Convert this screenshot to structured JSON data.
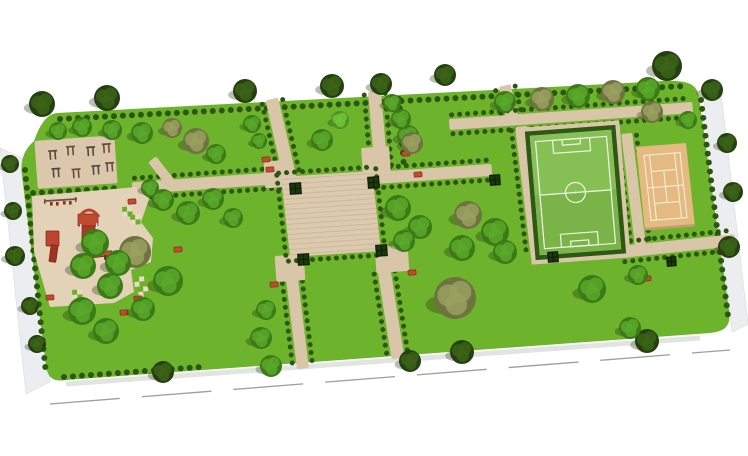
{
  "canvas": {
    "width": 748,
    "height": 456,
    "background": "#ffffff"
  },
  "palette": {
    "lawn": "#6db32c",
    "path": "#d9c6a8",
    "plaza": "#dccaae",
    "plaza_stripe": "#c9b493",
    "playground": "#e3d2b8",
    "fitness": "#dbc8ac",
    "pitch": "#86c055",
    "pitch_shade": "#7ab449",
    "pitch_line": "#eef7e6",
    "court": "#e4ba80",
    "court_edge": "#bf9e6b",
    "court_line": "#f7f2e8",
    "hedge": "#2c5512",
    "field_hedge": "#2d5a13",
    "planter_fill": "#1b370c",
    "planter_stroke": "#0a1804",
    "red": "#c14a2f",
    "red_dark": "#7c2517",
    "equipment": "#54483a",
    "equipment_alt": "#6b4a3a",
    "sidewalk": "#ecedf0",
    "sidewalk_edge": "#d9dbe0",
    "road_line": "#9c9ea0",
    "tree_shadow": "rgba(30,40,15,0.30)",
    "edge_shadow": "rgba(110,120,110,0.20)",
    "checker_green": "#6fae2c",
    "checker_cream": "#e8dcc4",
    "swing_frame": "#6a543e",
    "swing_seat": "#8a3020"
  },
  "tree_variants": {
    "dark": [
      "#234010",
      "#3c6318"
    ],
    "green": [
      "#3a7a17",
      "#5aa82c"
    ],
    "light": [
      "#4d9322",
      "#72c337"
    ],
    "olive": [
      "#6e7340",
      "#99a060"
    ]
  },
  "park_outline": "M 57 113 L 664 81 C 688 80 697 84 699 97 L 729 310 C 731 326 726 331 710 333 L 66 380 C 53 382 48 378 46 366 L 22 176 C 20 160 24 150 34 141 C 40 124 47 114 57 113 Z",
  "edge_shadow_line": [
    66,
    384,
    700,
    338
  ],
  "sidewalks": [
    {
      "name": "sidewalk-west",
      "points": "0,148 22,158 50,382 26,394"
    },
    {
      "name": "sidewalk-east",
      "points": "702,86 720,84 748,324 732,332"
    }
  ],
  "road_lines": [
    {
      "x1": 50,
      "y1": 404,
      "x2": 730,
      "y2": 350,
      "dash": "70 22"
    }
  ],
  "paths": [
    {
      "name": "entrance-path-northwest",
      "cx": 281,
      "cy": 139,
      "w": 13,
      "h": 82,
      "rot": -13,
      "hedge": true
    },
    {
      "name": "entrance-path-north",
      "cx": 378,
      "cy": 132,
      "w": 13,
      "h": 82,
      "rot": -5,
      "hedge": true
    },
    {
      "name": "entrance-path-northeast",
      "cx": 509,
      "cy": 104,
      "w": 12,
      "h": 38,
      "rot": -13,
      "hedge": true
    },
    {
      "name": "field-north-path",
      "cx": 571,
      "cy": 116,
      "w": 244,
      "h": 11,
      "rot": -4,
      "hedge": true
    },
    {
      "name": "field-west-path",
      "cx": 529,
      "cy": 192,
      "w": 12,
      "h": 132,
      "rot": -7,
      "hedge": true
    },
    {
      "name": "court-west-path",
      "cx": 634,
      "cy": 193,
      "w": 11,
      "h": 120,
      "rot": -7,
      "hedge": true
    },
    {
      "name": "court-south-path",
      "cx": 678,
      "cy": 246,
      "w": 115,
      "h": 12,
      "rot": -6,
      "hedge": true
    },
    {
      "name": "plaza-west-path",
      "cx": 208,
      "cy": 183,
      "w": 152,
      "h": 12,
      "rot": -4,
      "hedge": true
    },
    {
      "name": "plaza-east-path",
      "cx": 432,
      "cy": 174,
      "w": 120,
      "h": 12,
      "rot": -4,
      "hedge": true
    },
    {
      "name": "exit-path-southwest",
      "cx": 297,
      "cy": 320,
      "w": 12,
      "h": 98,
      "rot": -7,
      "hedge": true
    },
    {
      "name": "exit-path-south",
      "cx": 391,
      "cy": 314,
      "w": 13,
      "h": 90,
      "rot": -9,
      "hedge": true
    },
    {
      "name": "playground-link-path",
      "cx": 162,
      "cy": 172,
      "w": 10,
      "h": 32,
      "rot": -38,
      "hedge": false
    },
    {
      "name": "plaza-landing-nw",
      "cx": 278,
      "cy": 174,
      "w": 27,
      "h": 27,
      "rot": -4,
      "hedge": false
    },
    {
      "name": "plaza-landing-ne",
      "cx": 376,
      "cy": 161,
      "w": 28,
      "h": 28,
      "rot": -4,
      "hedge": false
    },
    {
      "name": "plaza-landing-sw",
      "cx": 290,
      "cy": 268,
      "w": 29,
      "h": 26,
      "rot": -4,
      "hedge": false
    },
    {
      "name": "plaza-landing-se",
      "cx": 392,
      "cy": 259,
      "w": 33,
      "h": 26,
      "rot": -4,
      "hedge": false
    }
  ],
  "hedge_lines": [
    [
      60,
      119,
      686,
      86
    ],
    [
      25,
      170,
      46,
      374
    ],
    [
      701,
      100,
      728,
      316
    ],
    [
      64,
      377,
      200,
      367
    ],
    [
      33,
      193,
      118,
      188
    ],
    [
      534,
      253,
      616,
      246
    ],
    [
      399,
      99,
      404,
      168
    ]
  ],
  "plaza": {
    "matrix": [
      1,
      -0.066,
      0.1125,
      1,
      281,
      177
    ],
    "w": 91,
    "h": 80
  },
  "soccer_field": {
    "matrix": [
      1,
      -0.074,
      0.084,
      1,
      530,
      136
    ],
    "w": 81,
    "h": 119,
    "apron": [
      -9,
      -9,
      99,
      137
    ],
    "boundary": [
      5,
      6,
      71,
      107
    ],
    "penalty_top": [
      22,
      6,
      37,
      13
    ],
    "penalty_bottom": [
      22,
      100,
      37,
      13
    ],
    "goal_top": [
      31.5,
      6,
      18,
      5.5
    ],
    "goal_bottom": [
      31.5,
      107.5,
      18,
      5.5
    ],
    "halfway_y": 59.5,
    "center": [
      40.5,
      59.5,
      10
    ]
  },
  "tennis_court": {
    "matrix": [
      1,
      -0.08,
      0.108,
      1,
      636,
      147
    ],
    "w": 50,
    "h": 83,
    "boundary": [
      7,
      9,
      36,
      65
    ],
    "singles_x": [
      12.5,
      37.5
    ],
    "service_y": [
      25.5,
      57.5
    ],
    "net_y": 41.5,
    "center_x": 25
  },
  "fitness_area": {
    "cx": 76,
    "cy": 162,
    "w": 80,
    "h": 48,
    "rot": -4,
    "equipment": [
      [
        -26,
        -12
      ],
      [
        -8,
        -15
      ],
      [
        12,
        -13
      ],
      [
        28,
        -15
      ],
      [
        -24,
        6
      ],
      [
        -4,
        8
      ],
      [
        16,
        6
      ],
      [
        30,
        4
      ]
    ]
  },
  "playground_polygon": "32,196 136,187 149,199 141,222 153,238 151,262 131,270 134,292 114,303 50,307 34,252",
  "swing_set": {
    "bar": [
      45,
      201,
      77,
      199
    ],
    "posts": [
      [
        44,
        199
      ],
      [
        75,
        197
      ]
    ],
    "seats": [
      [
        50,
        202
      ],
      [
        56,
        202
      ],
      [
        63,
        201
      ],
      [
        69,
        201
      ]
    ]
  },
  "play_structures": [
    {
      "t": "rect",
      "x": 46,
      "y": 231,
      "w": 13,
      "h": 15,
      "f": "#bc4430",
      "s": "#7c2517"
    },
    {
      "t": "rect",
      "x": 50,
      "y": 245,
      "w": 7,
      "h": 17,
      "f": "#a03322",
      "s": "#7c2517",
      "r": 8
    },
    {
      "t": "rect",
      "x": 78,
      "y": 214,
      "w": 20,
      "h": 12,
      "f": "#c04a30",
      "s": "#7c2517"
    },
    {
      "t": "rect",
      "x": 82,
      "y": 226,
      "w": 13,
      "h": 19,
      "f": "#ad3a26",
      "s": "#7c2517"
    },
    {
      "t": "arc",
      "x1": 79,
      "y1": 217,
      "qx": 89,
      "qy": 203,
      "x2": 99,
      "y2": 217,
      "s": "#b8452f",
      "sw": 3
    },
    {
      "t": "rect",
      "x": 80,
      "y": 224,
      "w": 1.5,
      "h": 8,
      "f": "#e8e2d8"
    },
    {
      "t": "rect",
      "x": 96,
      "y": 223,
      "w": 1.5,
      "h": 8,
      "f": "#e8e2d8"
    },
    {
      "t": "rect",
      "x": 86,
      "y": 252,
      "w": 26,
      "h": 5,
      "f": "#c5502f",
      "s": "#7c2517",
      "r": -6
    },
    {
      "t": "rect",
      "x": 90,
      "y": 257,
      "w": 3,
      "h": 5,
      "f": "#5a3a28"
    },
    {
      "t": "rect",
      "x": 104,
      "y": 255,
      "w": 3,
      "h": 5,
      "f": "#5a3a28"
    }
  ],
  "planters": [
    [
      290,
      183,
      11
    ],
    [
      368,
      177,
      11
    ],
    [
      298,
      254,
      11
    ],
    [
      376,
      245,
      11
    ],
    [
      490,
      175,
      10
    ],
    [
      548,
      252,
      10
    ],
    [
      667,
      257,
      9
    ]
  ],
  "red_benches": [
    [
      262,
      157
    ],
    [
      266,
      167
    ],
    [
      402,
      151
    ],
    [
      414,
      172
    ],
    [
      270,
      282
    ],
    [
      408,
      270
    ],
    [
      643,
      276
    ],
    [
      128,
      199
    ],
    [
      162,
      277
    ],
    [
      46,
      295
    ],
    [
      134,
      296
    ],
    [
      174,
      247
    ],
    [
      120,
      310
    ]
  ],
  "checker_tiles": [
    [
      122,
      207
    ],
    [
      130,
      215
    ],
    [
      72,
      290
    ],
    [
      80,
      298
    ],
    [
      134,
      277
    ],
    [
      138,
      287
    ]
  ],
  "trees": [
    [
      42,
      104,
      13,
      "dark"
    ],
    [
      107,
      98,
      13,
      "dark"
    ],
    [
      245,
      91,
      12,
      "dark"
    ],
    [
      332,
      86,
      12,
      "dark"
    ],
    [
      381,
      84,
      11,
      "dark"
    ],
    [
      445,
      75,
      11,
      "dark"
    ],
    [
      667,
      66,
      15,
      "dark"
    ],
    [
      712,
      90,
      11,
      "dark"
    ],
    [
      727,
      143,
      10,
      "dark"
    ],
    [
      733,
      192,
      10,
      "dark"
    ],
    [
      729,
      247,
      11,
      "dark"
    ],
    [
      10,
      164,
      9,
      "dark"
    ],
    [
      13,
      211,
      9,
      "dark"
    ],
    [
      15,
      256,
      10,
      "dark"
    ],
    [
      30,
      306,
      9,
      "dark"
    ],
    [
      37,
      344,
      9,
      "dark"
    ],
    [
      163,
      372,
      11,
      "dark"
    ],
    [
      410,
      361,
      11,
      "dark"
    ],
    [
      462,
      352,
      12,
      "dark"
    ],
    [
      647,
      341,
      12,
      "dark"
    ],
    [
      58,
      131,
      9,
      "green"
    ],
    [
      82,
      127,
      10,
      "green"
    ],
    [
      112,
      130,
      10,
      "green"
    ],
    [
      142,
      133,
      11,
      "green"
    ],
    [
      172,
      128,
      10,
      "olive"
    ],
    [
      196,
      141,
      13,
      "olive"
    ],
    [
      216,
      154,
      10,
      "green"
    ],
    [
      150,
      188,
      9,
      "green"
    ],
    [
      163,
      200,
      11,
      "green"
    ],
    [
      188,
      213,
      12,
      "green"
    ],
    [
      213,
      199,
      11,
      "green"
    ],
    [
      233,
      218,
      10,
      "green"
    ],
    [
      252,
      124,
      9,
      "green"
    ],
    [
      259,
      141,
      8,
      "green"
    ],
    [
      322,
      140,
      11,
      "green"
    ],
    [
      340,
      120,
      9,
      "light"
    ],
    [
      408,
      136,
      11,
      "green"
    ],
    [
      398,
      208,
      13,
      "green"
    ],
    [
      420,
      227,
      12,
      "green"
    ],
    [
      404,
      241,
      11,
      "green"
    ],
    [
      392,
      103,
      9,
      "green"
    ],
    [
      401,
      119,
      10,
      "green"
    ],
    [
      412,
      143,
      11,
      "olive"
    ],
    [
      505,
      102,
      11,
      "green"
    ],
    [
      542,
      99,
      12,
      "olive"
    ],
    [
      578,
      96,
      12,
      "green"
    ],
    [
      613,
      92,
      12,
      "olive"
    ],
    [
      648,
      89,
      12,
      "green"
    ],
    [
      468,
      215,
      14,
      "olive"
    ],
    [
      495,
      232,
      14,
      "green"
    ],
    [
      462,
      248,
      13,
      "green"
    ],
    [
      505,
      252,
      12,
      "green"
    ],
    [
      455,
      298,
      21,
      "olive"
    ],
    [
      592,
      289,
      14,
      "green"
    ],
    [
      630,
      328,
      11,
      "green"
    ],
    [
      638,
      275,
      10,
      "green"
    ],
    [
      652,
      112,
      11,
      "olive"
    ],
    [
      688,
      120,
      9,
      "green"
    ],
    [
      135,
      252,
      16,
      "olive"
    ],
    [
      168,
      281,
      15,
      "green"
    ],
    [
      95,
      243,
      14,
      "green"
    ],
    [
      118,
      263,
      13,
      "green"
    ],
    [
      83,
      266,
      13,
      "green"
    ],
    [
      110,
      286,
      13,
      "green"
    ],
    [
      82,
      311,
      14,
      "green"
    ],
    [
      106,
      331,
      13,
      "green"
    ],
    [
      143,
      309,
      12,
      "green"
    ],
    [
      266,
      310,
      10,
      "green"
    ],
    [
      261,
      338,
      11,
      "green"
    ],
    [
      271,
      366,
      11,
      "green"
    ]
  ]
}
